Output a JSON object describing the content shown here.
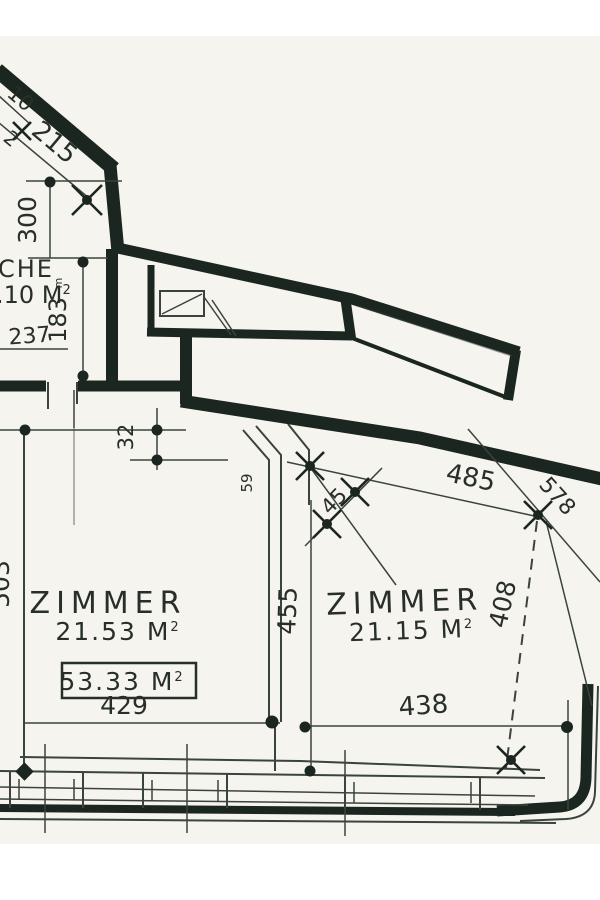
{
  "colors": {
    "paper": "#f6f4ef",
    "wall": "#1b2620",
    "line": "#3a443c",
    "text": "#272f28"
  },
  "rooms": {
    "kitchen": {
      "name": "CHE",
      "area": ".10 M",
      "area_sup": "2"
    },
    "left": {
      "name": "ZIMMER",
      "area": "21.53 M",
      "area_sup": "2"
    },
    "right": {
      "name": "ZIMMER",
      "area": "21.15 M",
      "area_sup": "2"
    }
  },
  "total": {
    "value": "53.33 M",
    "sup": "2"
  },
  "dims": {
    "top_fragment": "10",
    "top_fragment2": "2",
    "wall_215": "215",
    "kitchen_300": "300",
    "kitchen_237": "237",
    "kitchen_183": "183",
    "kitchen_183_sup": "m",
    "niche_32": "32",
    "left_503": "503",
    "partition_455": "455",
    "shaft_59": "59",
    "diag_485": "485",
    "diag_578": "578",
    "diag_45": "45",
    "right_408": "408",
    "left_room_429": "429",
    "right_room_438": "438"
  }
}
